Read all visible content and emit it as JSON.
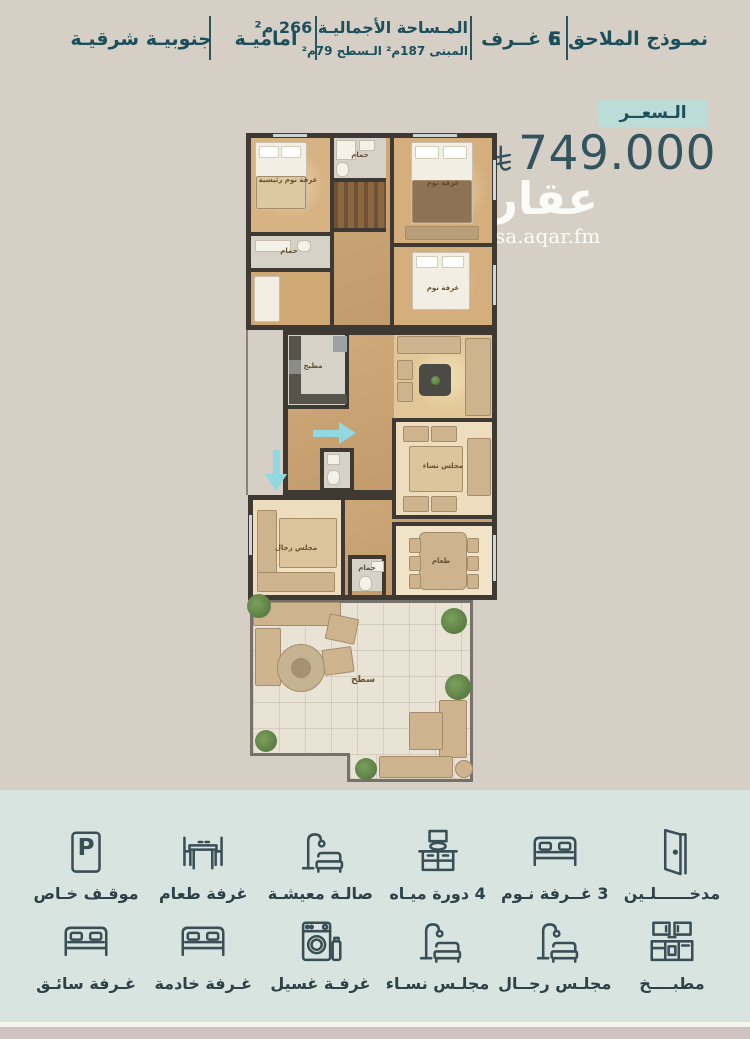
{
  "header": {
    "items": [
      {
        "id": "model",
        "label": "نمـوذج الملاحق E"
      },
      {
        "id": "rooms_count",
        "label": "6 غــرف"
      },
      {
        "id": "area",
        "line1": "المـساحة الأجماليـة 266 م²",
        "line2": "المبنى 187م²   الـسطح 79م²"
      },
      {
        "id": "facade",
        "label": "اماميـة"
      },
      {
        "id": "orientation",
        "label": "جنوبيـة شرقيـة"
      }
    ]
  },
  "price": {
    "badge_label": "الـسعــر",
    "amount": "749.000",
    "currency": "saudi-riyal"
  },
  "watermark": {
    "logo_text": "عقار",
    "site": "sa.aqar.fm"
  },
  "floor_plan": {
    "rooms": [
      {
        "label": "غرفة نوم رئيسية"
      },
      {
        "label": "حمام"
      },
      {
        "label": "غرفة نوم"
      },
      {
        "label": "حمام"
      },
      {
        "label": "غرفة نوم"
      },
      {
        "label": "مطبخ"
      },
      {
        "label": "مجلس نساء"
      },
      {
        "label": "مجلس رجال"
      },
      {
        "label": "حمام"
      },
      {
        "label": "طعام"
      },
      {
        "label": "سطح"
      }
    ]
  },
  "amenities": {
    "row1": [
      {
        "label": "مدخــــــلـين",
        "icon": "door-icon"
      },
      {
        "label": "3 غــرفة نـوم",
        "icon": "bed-icon"
      },
      {
        "label": "4 دورة ميـاه",
        "icon": "washbasin-icon"
      },
      {
        "label": "صالـة معيشـة",
        "icon": "sofa-lamp-icon"
      },
      {
        "label": "غرفة طعام",
        "icon": "dining-table-icon"
      },
      {
        "label": "موقـف خـاص",
        "icon": "parking-icon",
        "letter": "P"
      }
    ],
    "row2": [
      {
        "label": "مطبــــخ",
        "icon": "kitchen-icon"
      },
      {
        "label": "مجلـس رجــال",
        "icon": "sofa-lamp-icon"
      },
      {
        "label": "مجلـس نسـاء",
        "icon": "sofa-lamp-icon"
      },
      {
        "label": "غرفـة غسيل",
        "icon": "washing-machine-icon"
      },
      {
        "label": "غـرفة خادمة",
        "icon": "bed-icon"
      },
      {
        "label": "غـرفة سائـق",
        "icon": "bed-icon"
      }
    ]
  },
  "colors": {
    "background": "#d6cfc6",
    "panel_bg": "#d8e4e0",
    "badge_bg": "#bcdcd7",
    "teal_text": "#1d4f5b",
    "price_text": "#33545e",
    "icon": "#3a4e56",
    "entry_arrow": "#92d8e0"
  }
}
